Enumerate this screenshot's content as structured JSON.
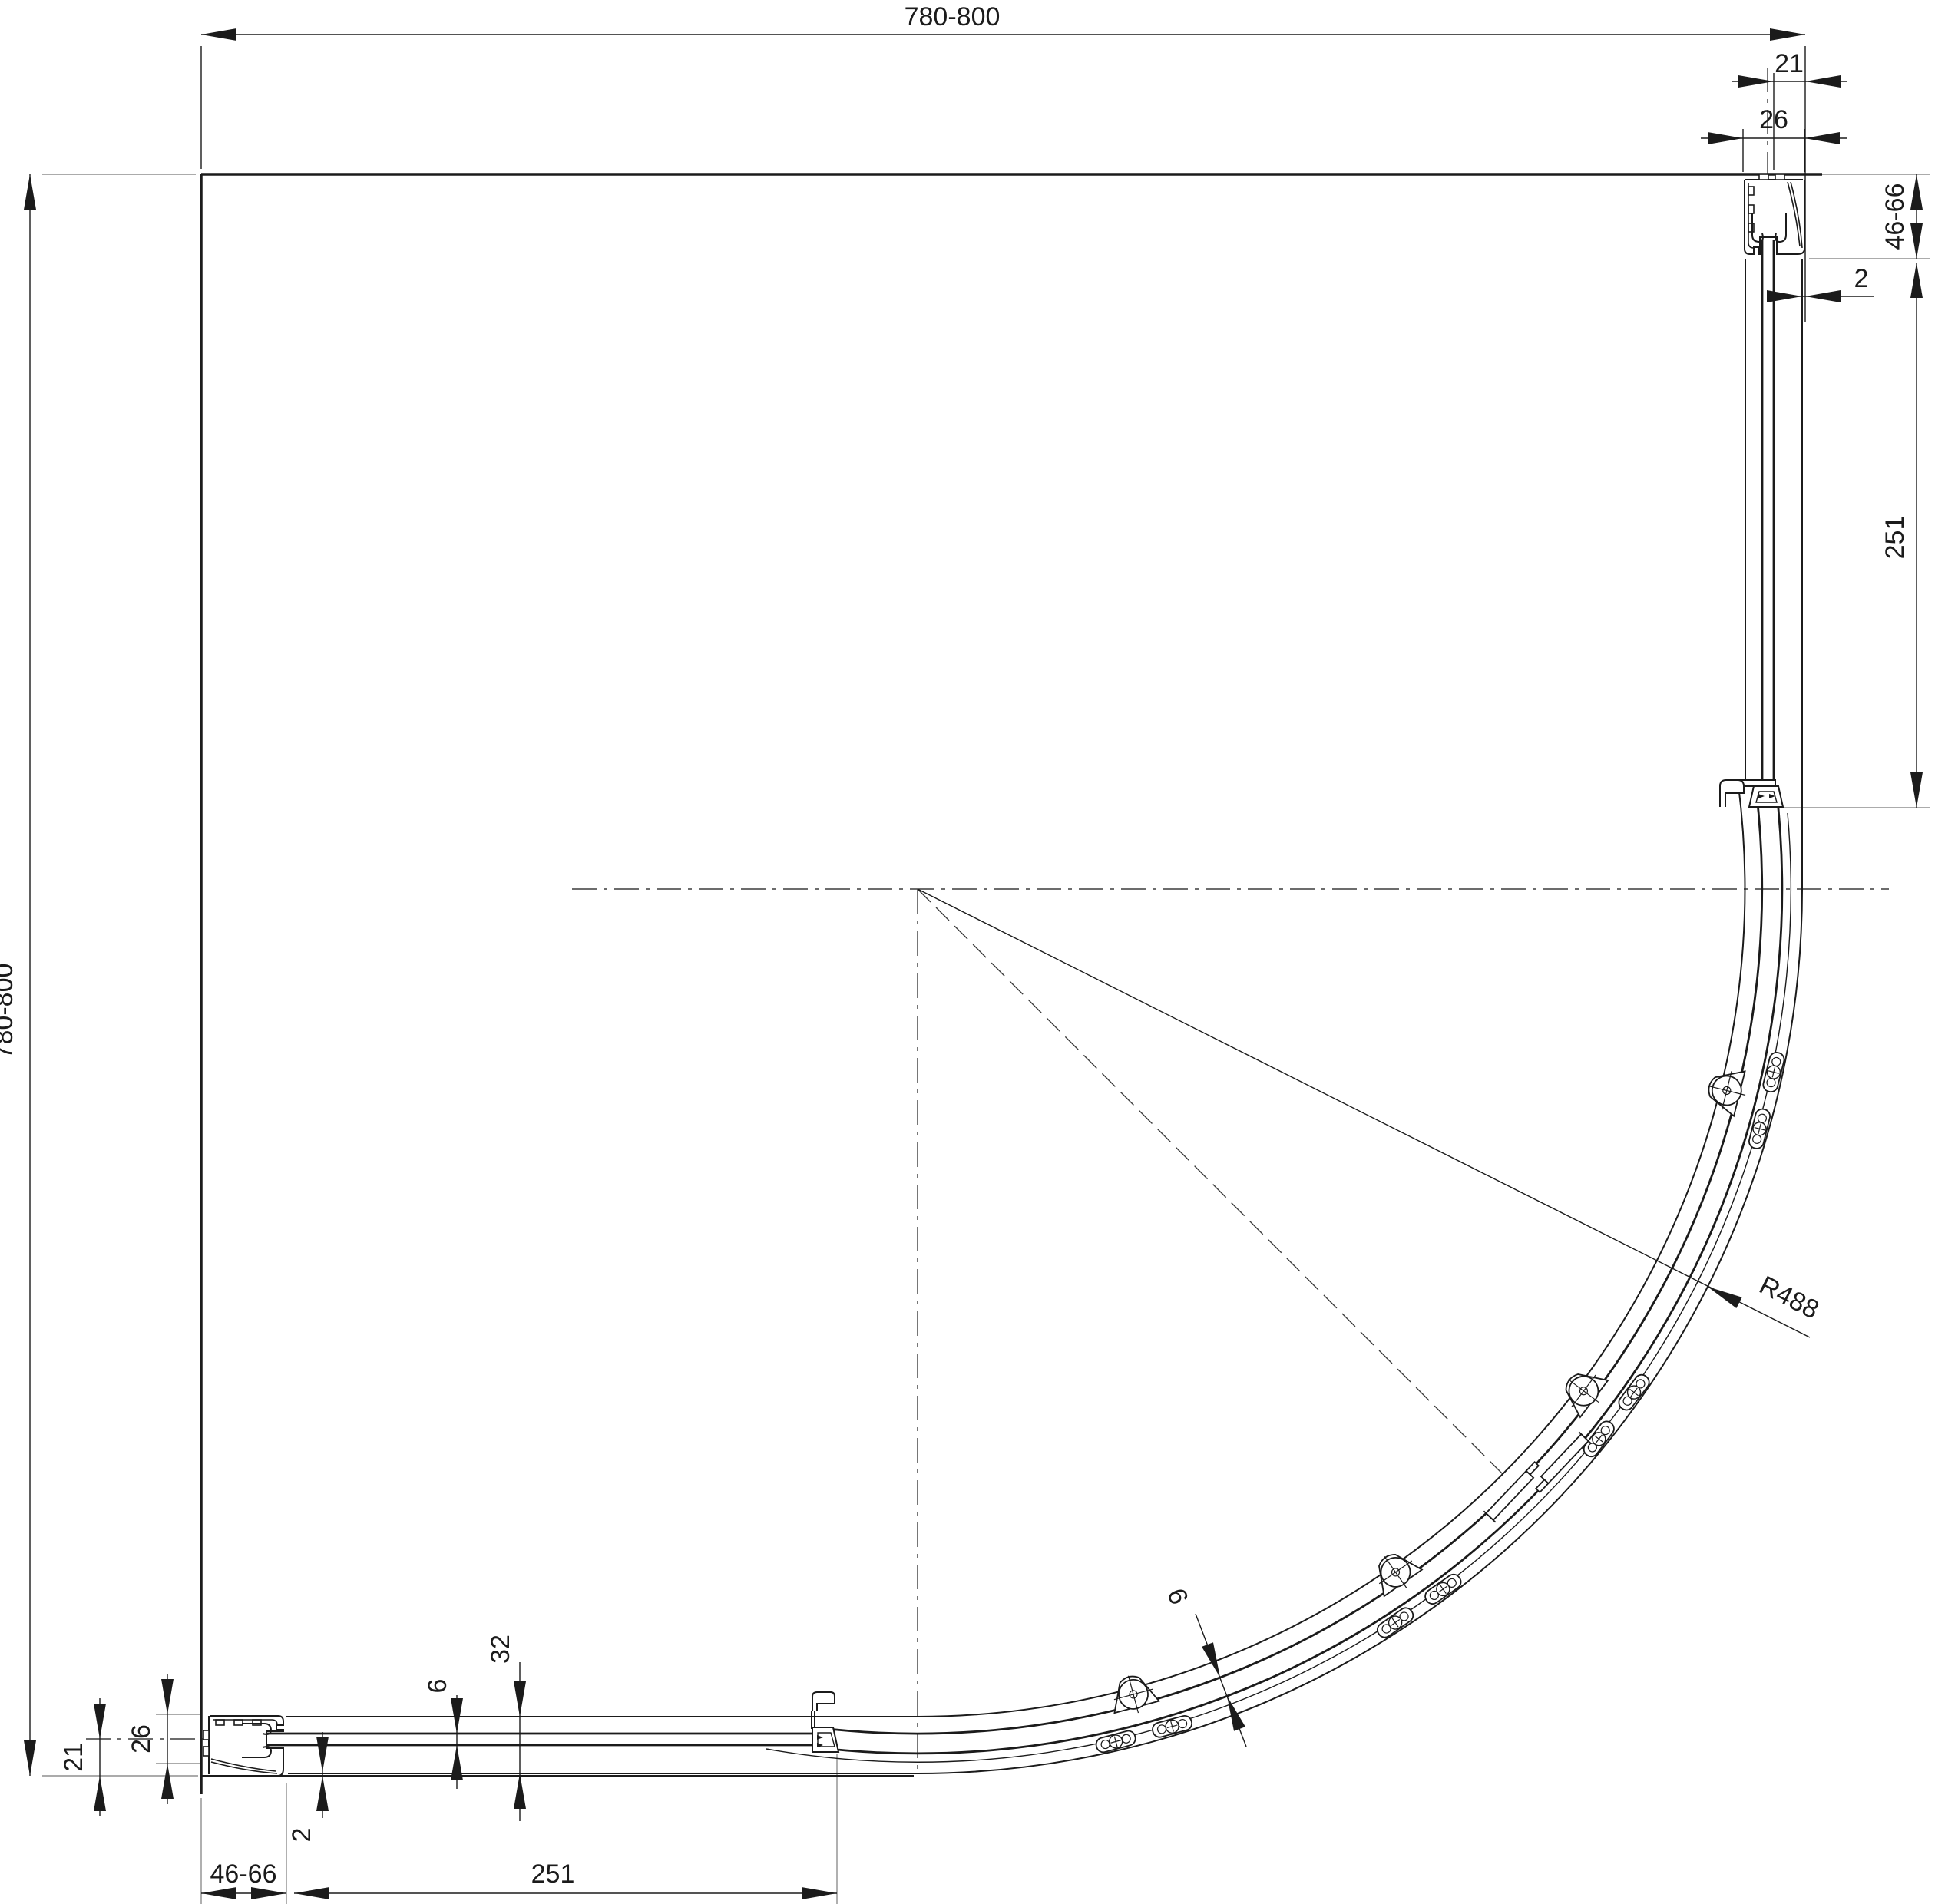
{
  "dimensions": {
    "overall_width": "780-800",
    "overall_depth": "780-800",
    "wall_offset": "21",
    "profile_width": "26",
    "wall_profile_range": "46-66",
    "wall_gap": "2",
    "fixed_segment_length": "251",
    "glass_thickness": "6",
    "track_width": "32",
    "radius": "R488",
    "curved_panel_thickness": "9"
  },
  "colors": {
    "line": "#1b1b1b",
    "extension": "#8f8f8f",
    "centerline": "#3c3c3c",
    "background": "#ffffff"
  }
}
